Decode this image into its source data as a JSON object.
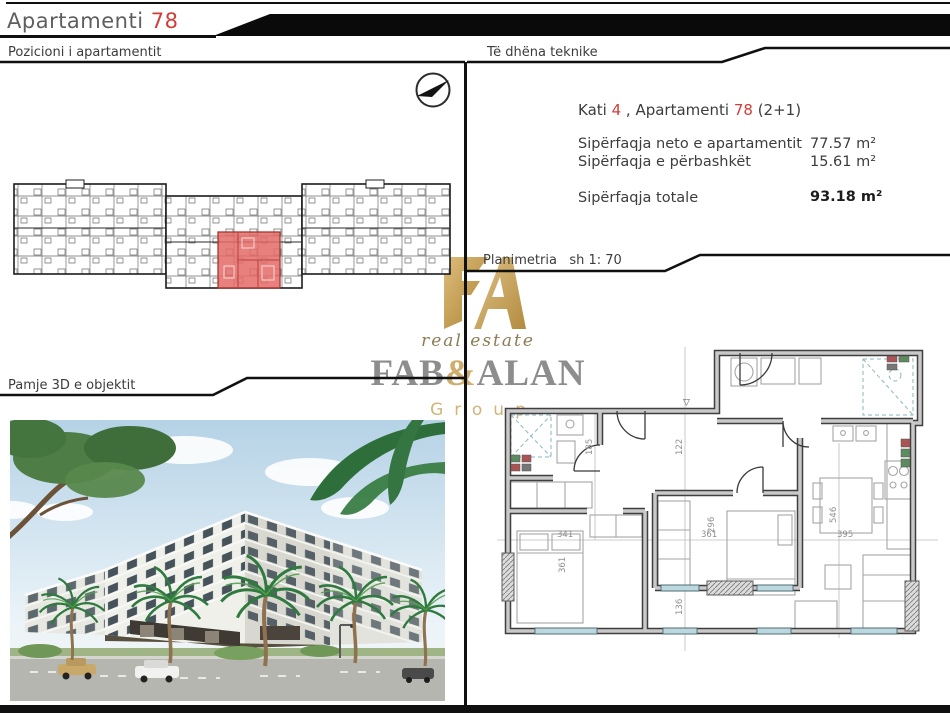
{
  "header": {
    "title": "Apartamenti",
    "title_number": "78"
  },
  "sections": {
    "position_label": "Pozicioni i apartamentit",
    "technical_label": "Të dhëna teknike",
    "view3d_label": "Pamje 3D e objektit",
    "plan_label": "Planimetria",
    "plan_scale": "sh 1: 70"
  },
  "technical": {
    "floor_label": "Kati",
    "floor_value": "4",
    "apartment_label": " , Apartamenti ",
    "apartment_value": "78",
    "apartment_type": " (2+1)",
    "rows": [
      {
        "label": "Sipërfaqja neto e apartamentit",
        "value": "77.57 m²"
      },
      {
        "label": "Sipërfaqja e përbashkët",
        "value": "15.61 m²"
      }
    ],
    "total_label": "Sipërfaqja totale",
    "total_value": "93.18 m²"
  },
  "logo": {
    "tagline": "real estate",
    "name_first": "FAB",
    "name_amp": "&",
    "name_last": "ALAN",
    "subtitle": "Group"
  },
  "plan": {
    "entry_marker": "▽",
    "dims": [
      "185",
      "122",
      "341",
      "361",
      "361",
      "296",
      "136",
      "395",
      "546"
    ]
  },
  "colors": {
    "accent_red": "#d23c38",
    "highlight_fill": "#e46a66",
    "gold": "#c7a05e",
    "logo_gray": "#8d8d8d"
  }
}
